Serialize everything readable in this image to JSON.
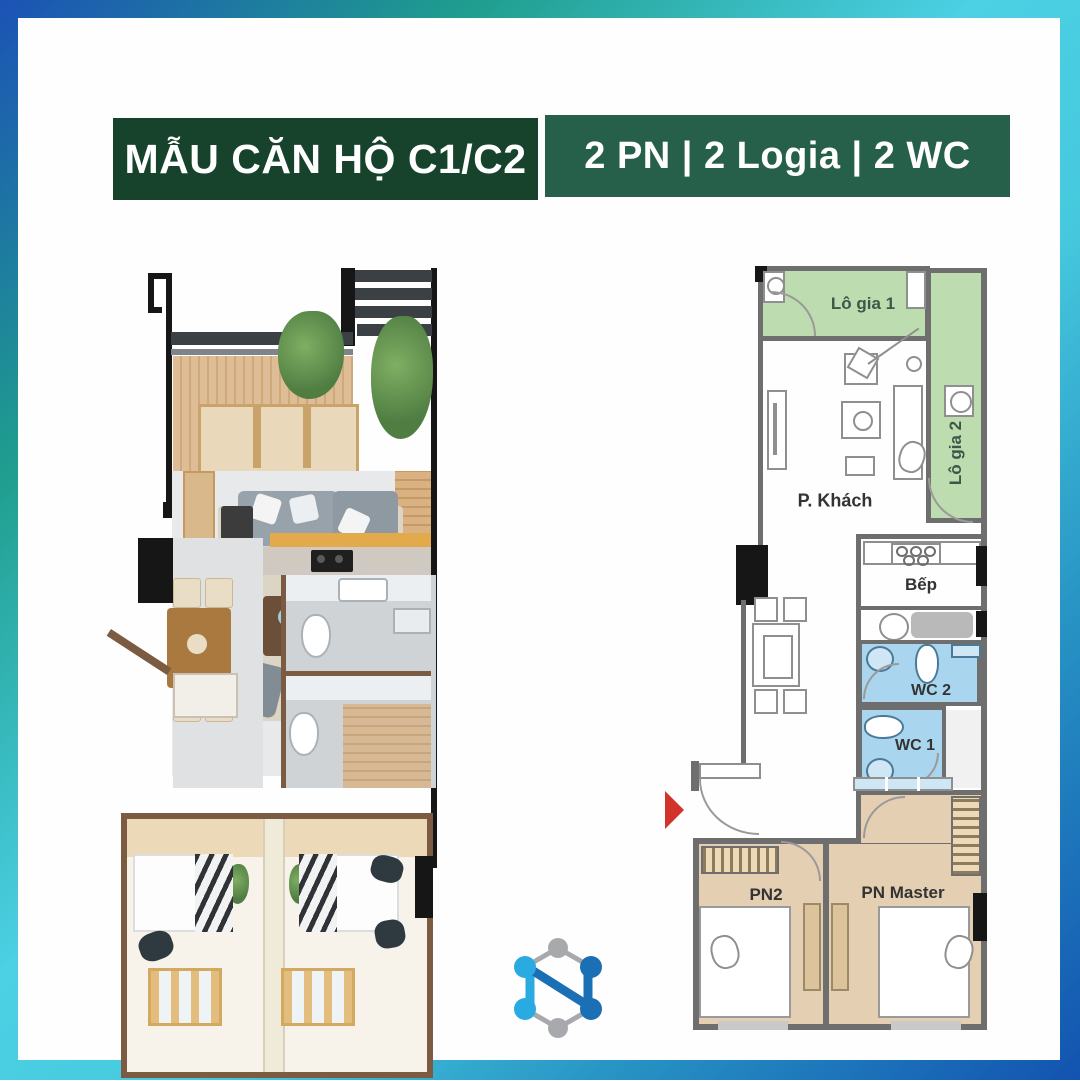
{
  "header": {
    "title": "MẪU CĂN HỘ C1/C2",
    "info": "2 PN  |  2 Logia  |  2 WC"
  },
  "plan2d": {
    "rooms": {
      "logia1": "Lô gia 1",
      "logia2": "Lô gia 2",
      "living": "P. Khách",
      "kitchen": "Bếp",
      "wc2": "WC 2",
      "wc1": "WC 1",
      "bedroom2": "PN2",
      "master": "PN Master"
    }
  },
  "colors": {
    "bg_blue": "#1c52b6",
    "bg_teal": "#1f9e8e",
    "bg_cyan": "#4bd0e4",
    "badge_dark_green": "#17432c",
    "badge_green": "#26604a",
    "loggia_green": "#bddcb0",
    "wc_blue": "#a9d6ee",
    "bedroom_tan": "#e5cfb2",
    "wall_gray": "#6e6e6e",
    "entry_arrow_red": "#d2342b",
    "logo_light_blue": "#29abe2",
    "logo_dark_blue": "#1b6fb5",
    "logo_gray": "#a7a9ac"
  }
}
